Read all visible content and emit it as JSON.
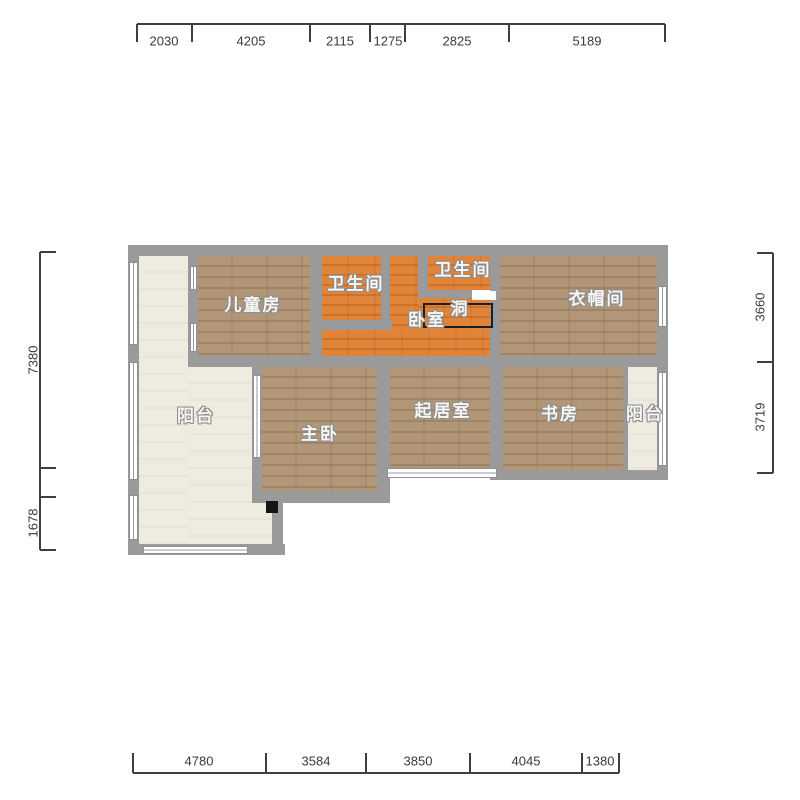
{
  "canvas": {
    "width": 800,
    "height": 800,
    "background": "#ffffff"
  },
  "colors": {
    "wall": "#9a9a9a",
    "wood_floor": "#b29678",
    "orange_floor": "#e0843a",
    "balcony_floor": "#efebe1",
    "dimension_text": "#3a3a3a",
    "room_label_text": "#f8f7f4",
    "hole_outline": "#1e1e1e"
  },
  "rooms": [
    {
      "name": "balcony-left",
      "label": "阳台",
      "floor": "cream",
      "x": 196,
      "y": 414
    },
    {
      "name": "kids-room",
      "label": "儿童房",
      "floor": "wood",
      "x": 253,
      "y": 303
    },
    {
      "name": "bathroom-left",
      "label": "卫生间",
      "floor": "orange",
      "x": 356,
      "y": 282
    },
    {
      "name": "bathroom-right",
      "label": "卫生间",
      "floor": "orange",
      "x": 463,
      "y": 268
    },
    {
      "name": "bedroom",
      "label": "卧室",
      "floor": "orange",
      "x": 427,
      "y": 318
    },
    {
      "name": "opening-hole",
      "label": "洞",
      "floor": "orange",
      "x": 460,
      "y": 307
    },
    {
      "name": "cloakroom",
      "label": "衣帽间",
      "floor": "wood",
      "x": 597,
      "y": 297
    },
    {
      "name": "master-bedroom",
      "label": "主卧",
      "floor": "wood",
      "x": 320,
      "y": 432
    },
    {
      "name": "living-room",
      "label": "起居室",
      "floor": "wood",
      "x": 443,
      "y": 409
    },
    {
      "name": "study",
      "label": "书房",
      "floor": "wood",
      "x": 560,
      "y": 412
    },
    {
      "name": "balcony-right",
      "label": "阳台",
      "floor": "cream",
      "x": 645,
      "y": 412
    }
  ],
  "dimensions": {
    "top": {
      "orient": "h",
      "line_pos": 24,
      "from": 137,
      "to": 665,
      "tick_len": 18,
      "label_off": 17,
      "ticks": [
        137,
        192,
        310,
        370,
        405,
        509,
        665
      ],
      "labels": [
        {
          "text": "2030",
          "at": 164
        },
        {
          "text": "4205",
          "at": 251
        },
        {
          "text": "2115",
          "at": 340
        },
        {
          "text": "1275",
          "at": 388
        },
        {
          "text": "2825",
          "at": 457
        },
        {
          "text": "5189",
          "at": 587
        }
      ]
    },
    "bottom": {
      "orient": "h",
      "line_pos": 773,
      "from": 133,
      "to": 619,
      "tick_len": -20,
      "label_off": -12,
      "ticks": [
        133,
        266,
        366,
        470,
        582,
        619
      ],
      "labels": [
        {
          "text": "4780",
          "at": 199
        },
        {
          "text": "3584",
          "at": 316
        },
        {
          "text": "3850",
          "at": 418
        },
        {
          "text": "4045",
          "at": 526
        },
        {
          "text": "1380",
          "at": 600
        }
      ]
    },
    "left": {
      "orient": "v",
      "line_pos": 40,
      "from": 252,
      "to": 550,
      "tick_len": 16,
      "label_off": -7,
      "ticks": [
        252,
        468,
        497,
        550
      ],
      "labels": [
        {
          "text": "7380",
          "at": 360
        },
        {
          "text": "1678",
          "at": 523
        }
      ]
    },
    "right": {
      "orient": "v",
      "line_pos": 773,
      "from": 253,
      "to": 473,
      "tick_len": -16,
      "label_off": -13,
      "ticks": [
        253,
        362,
        473
      ],
      "labels": [
        {
          "text": "3660",
          "at": 307
        },
        {
          "text": "3719",
          "at": 417
        }
      ]
    }
  }
}
